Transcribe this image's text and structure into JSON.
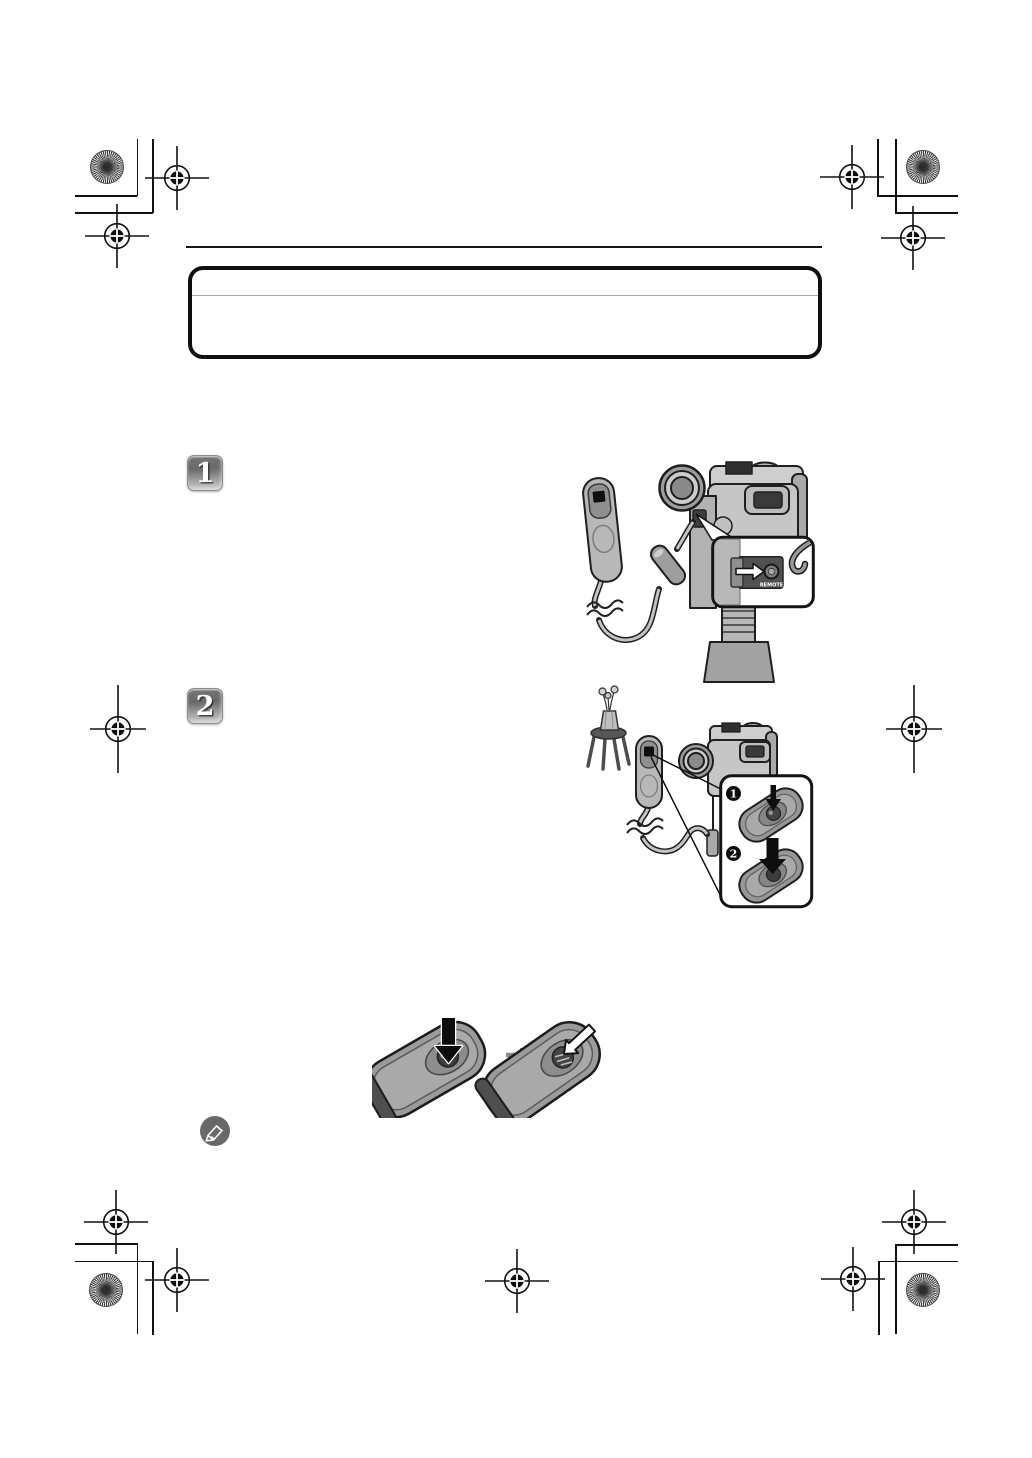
{
  "document": {
    "type": "instruction-manual-page",
    "background": "#ffffff",
    "content_note": "print proof page: graphics layer only, text layer blank"
  },
  "steps": [
    {
      "number": "1"
    },
    {
      "number": "2"
    }
  ],
  "step1": {
    "remote_jack_label": "REMOTE"
  },
  "step2": {
    "press_steps": [
      {
        "number": "1"
      },
      {
        "number": "2"
      }
    ]
  },
  "icons": {
    "note_icon": "pencil-note",
    "registration_mark": "crosshair-target",
    "star_target": "pinwheel-star"
  },
  "colors": {
    "ink": "#111111",
    "gray_light": "#c6c6c6",
    "gray_mid": "#9a9a9a",
    "gray_dark": "#515151",
    "badge_text": "#ffffff"
  }
}
